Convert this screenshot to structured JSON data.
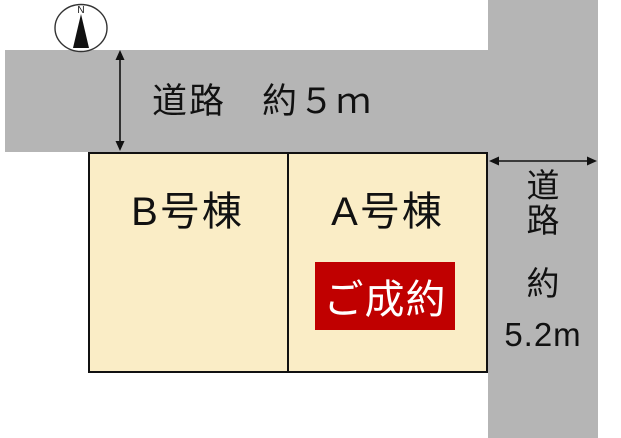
{
  "diagram_type": "real-estate site plan",
  "compass": {
    "label": "N"
  },
  "road_top": {
    "label": "道路",
    "width_label": "約５ｍ"
  },
  "road_right": {
    "label_chars": [
      "道",
      "路"
    ],
    "approx_label": "約",
    "width_label": "5.2m"
  },
  "plots": [
    {
      "id": "B",
      "label": "B号棟",
      "status": ""
    },
    {
      "id": "A",
      "label": "A号棟",
      "status": "ご成約"
    }
  ],
  "colors": {
    "road_fill": "#b5b5b5",
    "plot_fill": "#faedc6",
    "plot_border": "#111111",
    "sold_badge_fill": "#c00000",
    "sold_badge_text": "#ffffff",
    "text": "#111111"
  }
}
